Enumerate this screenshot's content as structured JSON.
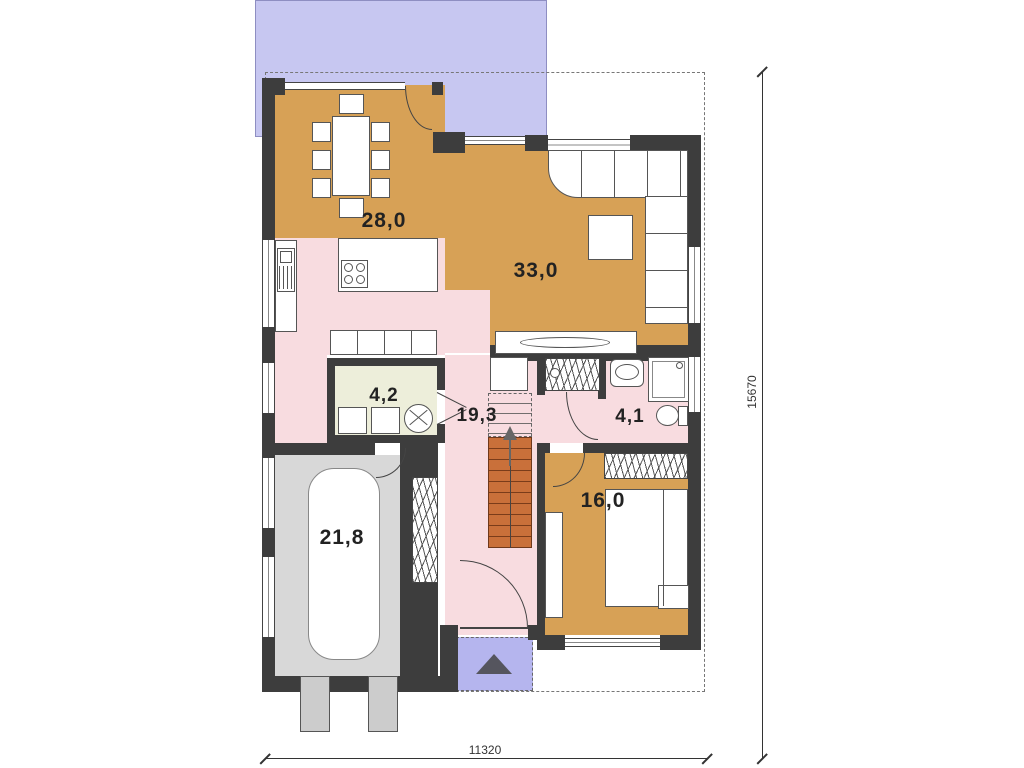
{
  "plan_title": "house-ground-floor-plan",
  "rooms": [
    {
      "name": "dining-room",
      "area": "28,0"
    },
    {
      "name": "living-room",
      "area": "33,0"
    },
    {
      "name": "utility-room",
      "area": "4,2"
    },
    {
      "name": "hallway",
      "area": "19,3"
    },
    {
      "name": "bathroom",
      "area": "4,1"
    },
    {
      "name": "bedroom",
      "area": "16,0"
    },
    {
      "name": "garage",
      "area": "21,8"
    }
  ],
  "dimensions": {
    "bottom": "11320",
    "right": "15670"
  },
  "colors": {
    "warm_room": "#d7a156",
    "soft_room": "#f8dce0",
    "utility_room": "#edeeda",
    "garage": "#d8d8d8",
    "terrace": "#c7c7f1",
    "entrance_pad": "#b5b5ee",
    "wall": "#3d3d3d",
    "stairs": "#c9703a"
  }
}
